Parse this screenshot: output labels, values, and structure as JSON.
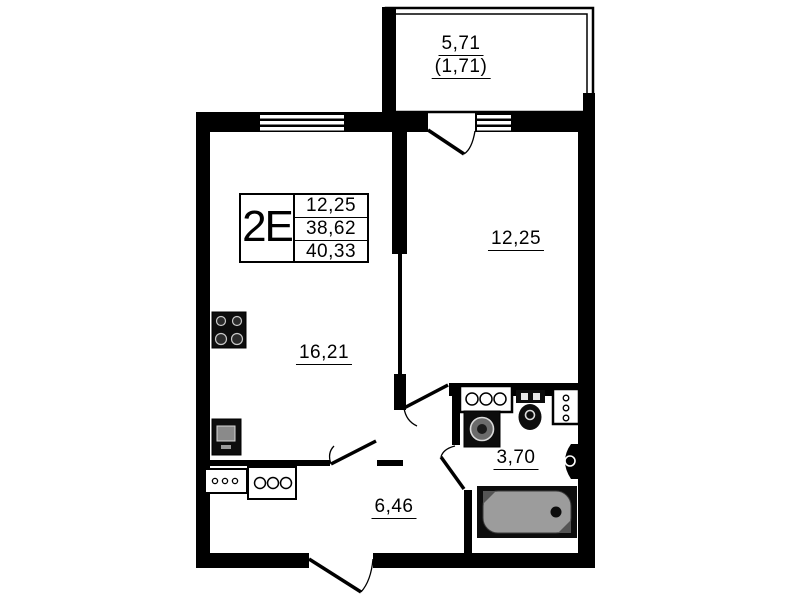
{
  "legend": {
    "unit": "2E",
    "values": [
      "12,25",
      "38,62",
      "40,33"
    ]
  },
  "rooms": {
    "balcony": {
      "area": "5,71",
      "area_secondary": "(1,71)"
    },
    "bedroom": {
      "area": "12,25"
    },
    "living_kitchen": {
      "area": "16,21"
    },
    "hallway": {
      "area": "6,46"
    },
    "bathroom": {
      "area": "3,70"
    }
  },
  "fixtures": [
    "stove-icon",
    "kitchen-sink-icon",
    "counter-icon",
    "washbasin-icon",
    "washing-machine-icon",
    "toilet-icon",
    "shelf-icon",
    "vent-icon",
    "bathtub-icon"
  ],
  "colors": {
    "wall": "#000000",
    "background": "#ffffff",
    "bathtub_fill": "#9c9c9c"
  }
}
